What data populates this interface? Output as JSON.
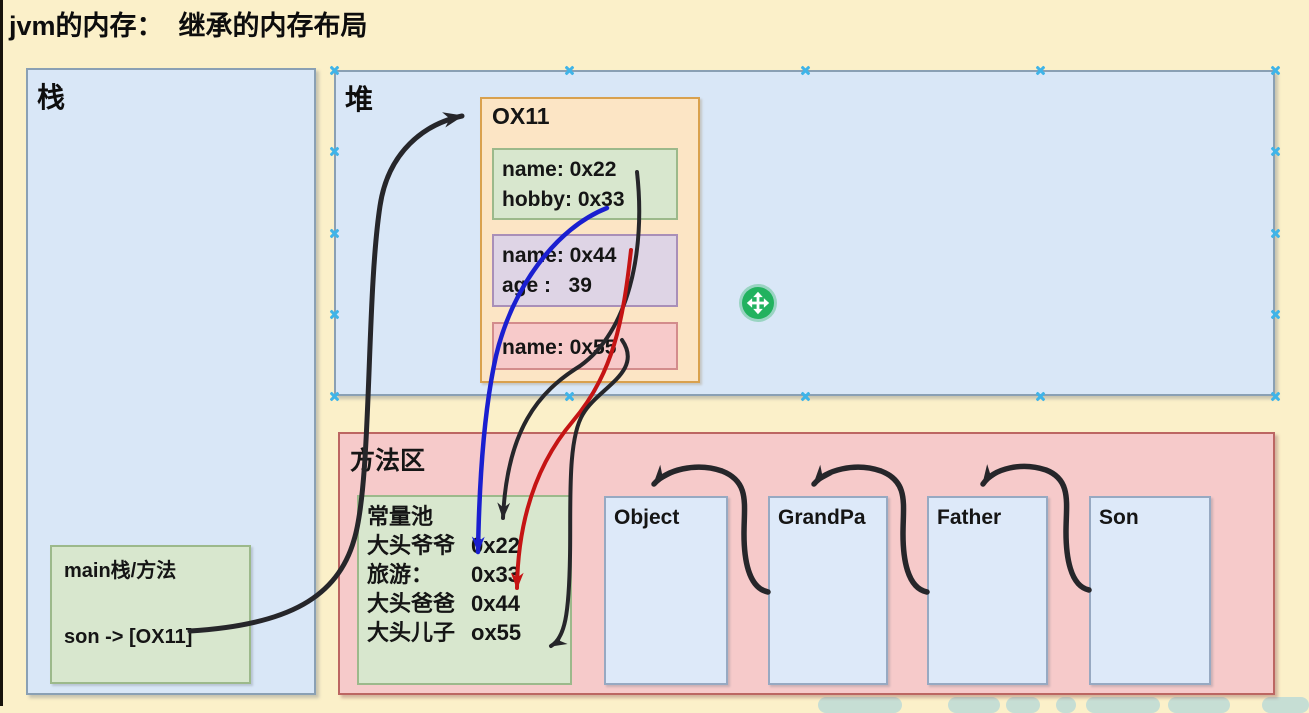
{
  "title": "jvm的内存：  继承的内存布局",
  "stack": {
    "label": "栈",
    "main_frame": {
      "title": "main栈/方法",
      "entry": "son -> [OX11]"
    }
  },
  "heap": {
    "label": "堆",
    "instance": {
      "address": "OX11",
      "son_part": {
        "line1": "name: 0x22",
        "line2": "hobby: 0x33"
      },
      "father_part": {
        "line1": "name: 0x44",
        "line2": "age :   39"
      },
      "grandpa_part": {
        "line1": "name: 0x55"
      }
    }
  },
  "method_area": {
    "label": "方法区",
    "constant_pool": {
      "title": "常量池",
      "entries": [
        {
          "name": "大头爷爷",
          "value": "0x22"
        },
        {
          "name": "旅游：",
          "value": "0x33"
        },
        {
          "name": "大头爸爸",
          "value": "0x44"
        },
        {
          "name": "大头儿子",
          "value": "ox55"
        }
      ]
    },
    "classes": [
      {
        "name": "Object"
      },
      {
        "name": "GrandPa"
      },
      {
        "name": "Father"
      },
      {
        "name": "Son"
      }
    ]
  },
  "colors": {
    "background": "#fbf0c9",
    "box_blue_fill": "#d9e7f7",
    "box_blue_stroke": "#8aa0b4",
    "box_green_fill": "#d8e7ce",
    "box_green_stroke": "#9cb98b",
    "box_orange_fill": "#fce5c5",
    "box_orange_stroke": "#d9a14e",
    "box_purple_fill": "#ded4e5",
    "box_purple_stroke": "#a98fb8",
    "box_pink_fill": "#f7caca",
    "box_pink_stroke": "#bc6662",
    "arrow_black": "#26262a",
    "arrow_blue": "#1a1fd0",
    "arrow_red": "#c51414",
    "selection_handle": "#3fb4e8",
    "move_cursor": "#22b25f"
  }
}
